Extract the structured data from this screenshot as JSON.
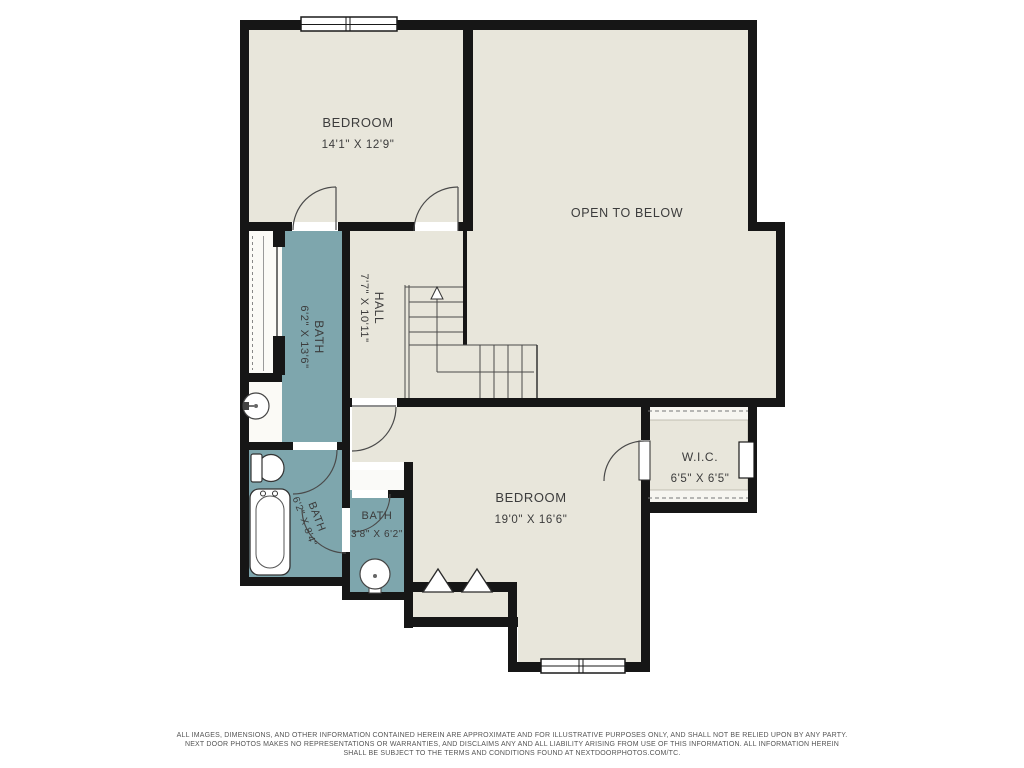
{
  "rooms": {
    "bedroom_top": {
      "name": "BEDROOM",
      "dims": "14'1\" X 12'9\""
    },
    "open_below": {
      "name": "OPEN TO BELOW"
    },
    "hall": {
      "name": "HALL",
      "dims": "7'7\" X 10'11\""
    },
    "bath_main": {
      "name": "BATH",
      "dims": "6'2\" X 13'6\""
    },
    "bath_lower": {
      "name": "BATH",
      "dims": "6'2\" X 8'4\""
    },
    "bath_small": {
      "name": "BATH",
      "dims": "3'8\" X 6'2\""
    },
    "bedroom_bottom": {
      "name": "BEDROOM",
      "dims": "19'0\" X 16'6\""
    },
    "wic": {
      "name": "W.I.C.",
      "dims": "6'5\" X 6'5\""
    }
  },
  "footer": {
    "line1": "ALL IMAGES, DIMENSIONS, AND OTHER INFORMATION CONTAINED HEREIN ARE APPROXIMATE AND FOR ILLUSTRATIVE PURPOSES ONLY, AND SHALL NOT BE RELIED UPON BY ANY PARTY.",
    "line2": "NEXT DOOR PHOTOS MAKES NO REPRESENTATIONS OR WARRANTIES, AND DISCLAIMS ANY AND ALL LIABILITY ARISING FROM USE OF THIS INFORMATION. ALL INFORMATION HEREIN",
    "line3": "SHALL BE SUBJECT TO THE TERMS AND CONDITIONS FOUND AT NEXTDOORPHOTOS.COM/TC."
  },
  "colors": {
    "wall": "#161616",
    "floor": "#e8e6db",
    "bath": "#7ea6ad",
    "fixture_outline": "#444444",
    "label_text": "#3c3c3c"
  }
}
